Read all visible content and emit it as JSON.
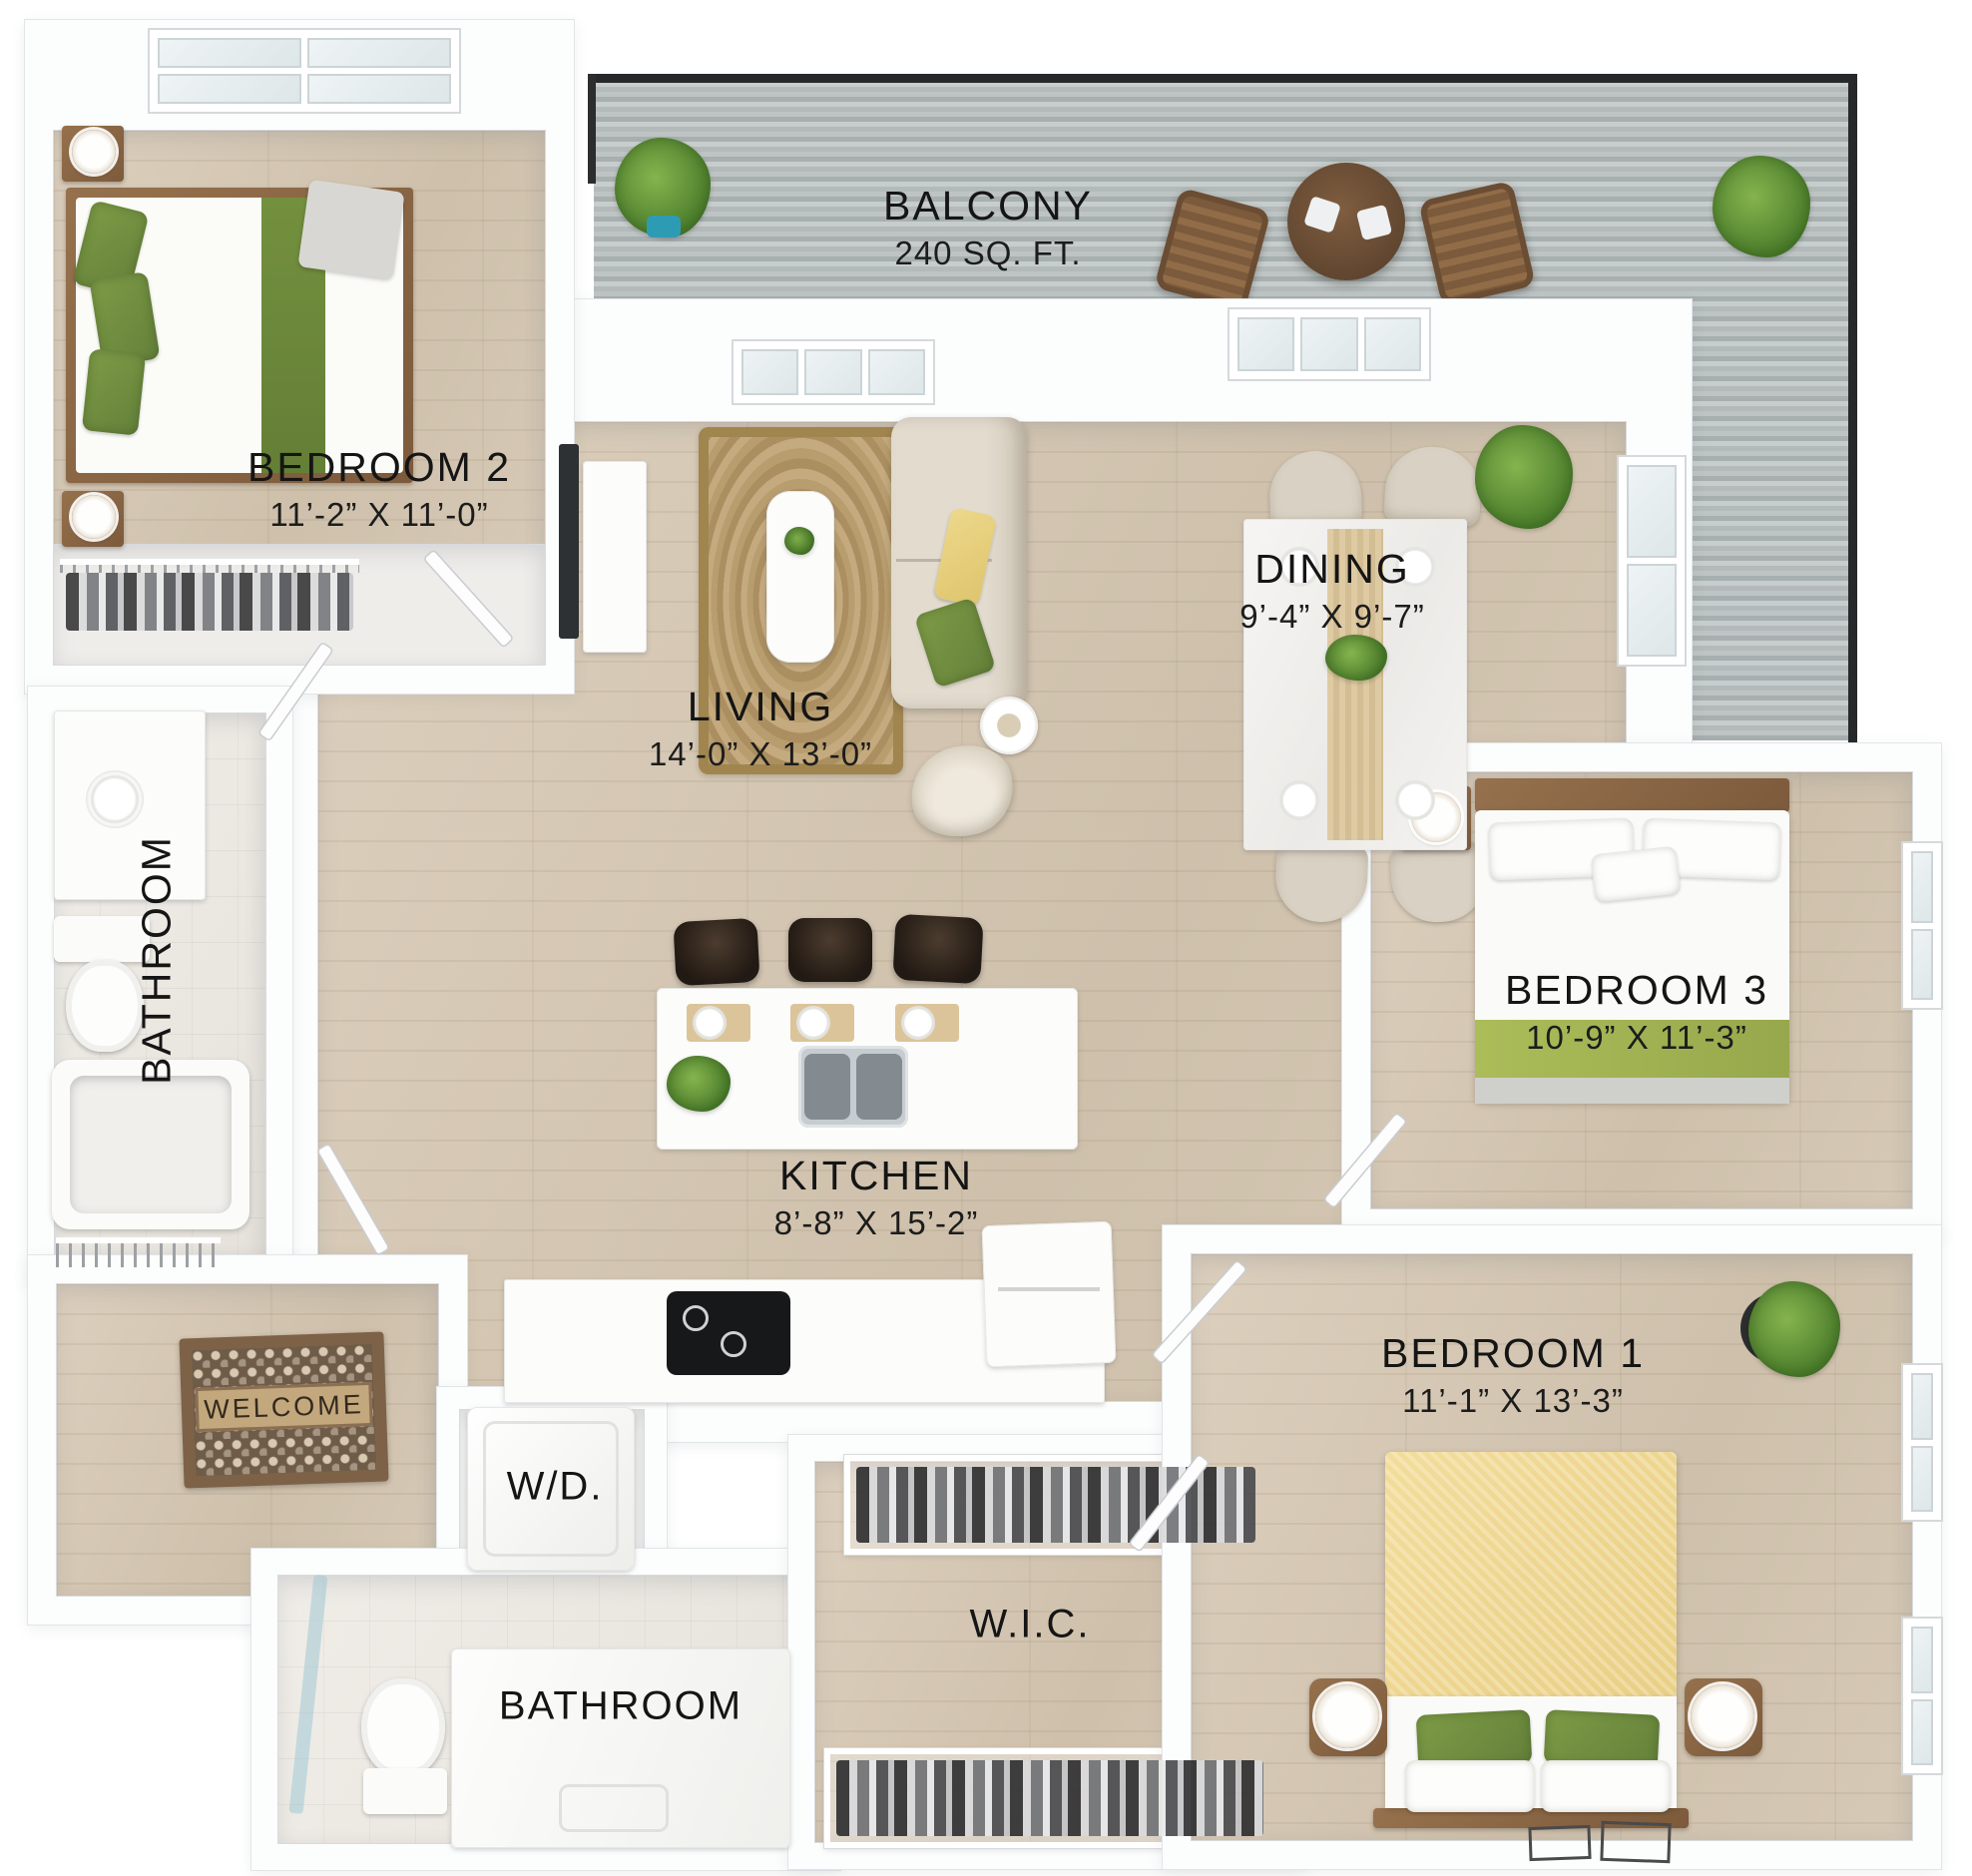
{
  "page": {
    "type": "3D apartment floor plan, top-down render"
  },
  "rooms": {
    "balcony": {
      "name": "BALCONY",
      "dims": "240 SQ. FT."
    },
    "bedroom2": {
      "name": "BEDROOM 2",
      "dims": "11’-2” X 11’-0”"
    },
    "living": {
      "name": "LIVING",
      "dims": "14’-0” X 13’-0”"
    },
    "dining": {
      "name": "DINING",
      "dims": "9’-4” X 9’-7”"
    },
    "bathroom_upper": {
      "name": "BATHROOM"
    },
    "bedroom3": {
      "name": "BEDROOM 3",
      "dims": "10’-9” X 11’-3”"
    },
    "kitchen": {
      "name": "KITCHEN",
      "dims": "8’-8” X 15’-2”"
    },
    "bedroom1": {
      "name": "BEDROOM 1",
      "dims": "11’-1” X 13’-3”"
    },
    "laundry": {
      "name": "W/D."
    },
    "wic": {
      "name": "W.I.C."
    },
    "bathroom_lower": {
      "name": "BATHROOM"
    },
    "doormat": {
      "text": "WELCOME"
    }
  },
  "colors": {
    "wood_floor": "#d3c5b1",
    "balcony_deck": "#b6bdbc",
    "wall": "#fcfdfd",
    "accent_green": "#75913f",
    "accent_yellow": "#f0da9a",
    "rug_jute": "#b59a6e",
    "label_text": "#161616"
  }
}
